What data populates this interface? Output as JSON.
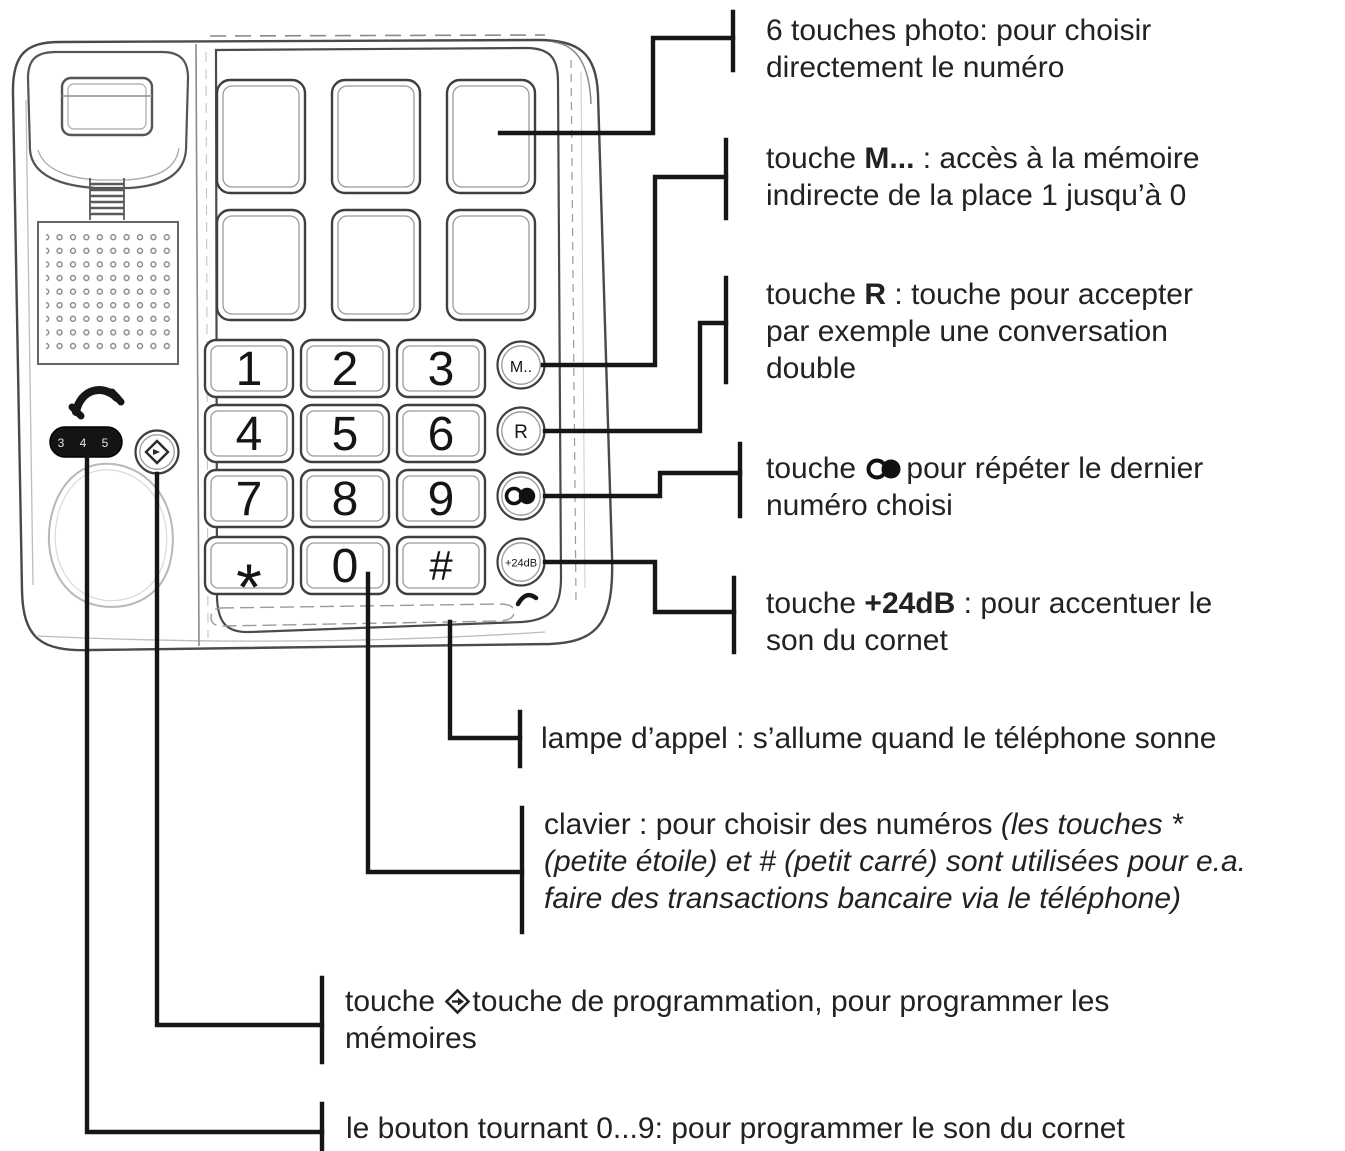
{
  "title": "Telephone diagram with French callout annotations",
  "colors": {
    "line_art": "#4a4a4a",
    "key_outline": "#3f3f3f",
    "inner_bevel": "#9a9a9a",
    "callout": "#161616",
    "text": "#222222",
    "dial_bg": "#141414",
    "dial_text": "#e3e3e3"
  },
  "phone": {
    "keypad": [
      "1",
      "2",
      "3",
      "4",
      "5",
      "6",
      "7",
      "8",
      "9",
      "*",
      "0",
      "#"
    ],
    "side_keys": {
      "memory": "M..",
      "flash": "R",
      "redial": "redial-icon",
      "amplify": "+24dB"
    },
    "dial_numbers": "3 4 5",
    "photo_key_count": "6"
  },
  "annotations": {
    "photo": {
      "l1": "6 touches photo: pour choisir",
      "l2": "directement le numéro"
    },
    "memory": {
      "l1_pre": "touche ",
      "l1_key": "M...",
      "l1_post": " : accès à la mémoire",
      "l2": "indirecte de la place 1 jusqu’à 0"
    },
    "flash": {
      "l1_pre": "touche ",
      "l1_key": "R",
      "l1_post": " : touche pour accepter",
      "l2": "par exemple une conversation",
      "l3": "double"
    },
    "redial": {
      "l1_pre": "touche ",
      "l1_post": "pour répéter le dernier",
      "l2": "numéro choisi"
    },
    "amplify": {
      "l1_pre": "touche ",
      "l1_key": "+24dB",
      "l1_post": " : pour accentuer le",
      "l2": "son du cornet"
    },
    "lamp": {
      "text": "lampe d’appel : s’allume quand le téléphone sonne"
    },
    "keypad": {
      "l1_pre": "clavier : pour choisir des numéros ",
      "l1_italic": "(les touches *",
      "l2": "(petite étoile) et # (petit carré) sont utilisées pour e.a.",
      "l3": "faire des transactions bancaire via le téléphone)"
    },
    "program": {
      "l1_pre": "touche ",
      "l1_post": "touche de programmation, pour programmer les",
      "l2": "mémoires"
    },
    "rotary": {
      "text": "le bouton tournant 0...9: pour programmer le son du cornet"
    }
  }
}
